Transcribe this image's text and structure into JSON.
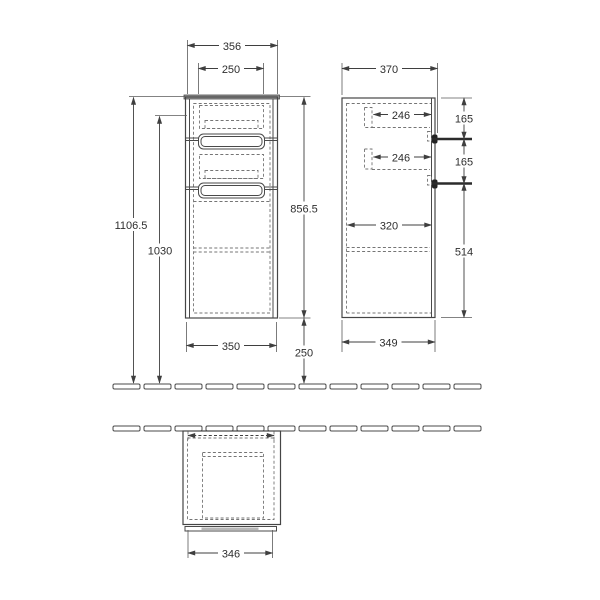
{
  "drawing": {
    "dimensions": {
      "front_overall_width": "356",
      "front_drawer_width": "250",
      "front_total_height": "1106.5",
      "front_upper_height": "1030",
      "front_cabinet_height": "856.5",
      "front_bottom_width": "350",
      "front_floor_clearance": "250",
      "side_overall_depth": "370",
      "side_top_drawer_depth": "246",
      "side_bottom_drawer_depth": "246",
      "side_top_handle_spacing": "165",
      "side_bottom_handle_spacing": "165",
      "side_shelf_depth": "320",
      "side_lower_height": "514",
      "side_bottom_depth": "349",
      "plan_overall_width": "346"
    },
    "colors": {
      "line": "#4a4a4a",
      "dashed_line": "#757575",
      "text": "#2e2e2e",
      "handle": "#222222",
      "top_panel": "#969696",
      "background": "#ffffff"
    }
  }
}
